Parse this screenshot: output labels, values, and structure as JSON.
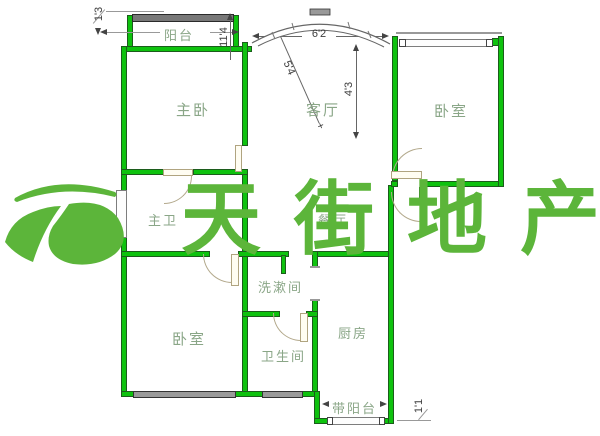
{
  "watermark": {
    "text": "天街地产",
    "color": "#5cb53a"
  },
  "rooms": {
    "balcony_top": {
      "label": "阳台"
    },
    "master_bedroom": {
      "label": "主卧"
    },
    "living_room": {
      "label": "客厅"
    },
    "bedroom_right": {
      "label": "卧室"
    },
    "master_bath": {
      "label": "主卫"
    },
    "dining": {
      "label": "餐厅"
    },
    "washroom": {
      "label": "洗漱间"
    },
    "bedroom_left": {
      "label": "卧室"
    },
    "bathroom": {
      "label": "卫生间"
    },
    "kitchen": {
      "label": "厨房"
    },
    "balcony_bottom": {
      "label": "带阳台"
    }
  },
  "dimensions": {
    "top_left_offset": {
      "text": "1'3"
    },
    "balcony_width": {
      "text": "11'4"
    },
    "bay_width": {
      "text": "6'2"
    },
    "bay_diagonal": {
      "text": "5'4"
    },
    "bay_depth": {
      "text": "4'3"
    },
    "bay_tick": {
      "text": "+"
    },
    "bottom_offset": {
      "text": "1'1"
    }
  },
  "colors": {
    "wall_fill": "#0ec20e",
    "wall_edge": "#1c5c1c",
    "watermark_green": "#5cb53a",
    "room_label": "#8aa687",
    "dimension_text": "#3d3d3d",
    "window_dark": "#787878"
  }
}
